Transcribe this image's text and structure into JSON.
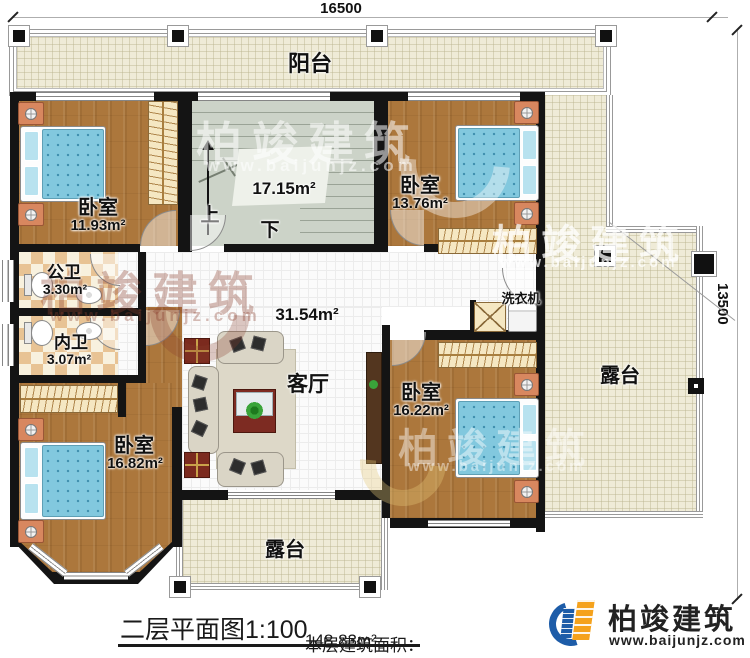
{
  "plan": {
    "title": "二层平面图1:100",
    "area_note_label": "本层建筑面积：",
    "area_note_value": "148.83m²"
  },
  "dimensions": {
    "top": "16500",
    "right": "13500"
  },
  "rooms": {
    "balcony": {
      "label": "阳台"
    },
    "bedroom_tl": {
      "label": "卧室",
      "area": "11.93m²"
    },
    "stair": {
      "area": "17.15m²",
      "up": "上",
      "down": "下"
    },
    "bedroom_tr": {
      "label": "卧室",
      "area": "13.76m²"
    },
    "bath_public": {
      "label": "公卫",
      "area": "3.30m²"
    },
    "bath_inner": {
      "label": "内卫",
      "area": "3.07m²"
    },
    "hall": {
      "area": "31.54m²"
    },
    "living": {
      "label": "客厅"
    },
    "bedroom_bl": {
      "label": "卧室",
      "area": "16.82m²"
    },
    "bedroom_br": {
      "label": "卧室",
      "area": "16.22m²"
    },
    "laundry": {
      "label": "洗衣机"
    },
    "terrace_right": {
      "label": "露台"
    },
    "terrace_bottom": {
      "label": "露台"
    }
  },
  "branding": {
    "company": "柏竣建筑",
    "website": "www.baijunjz.com"
  },
  "watermark": {
    "text": "柏竣建筑",
    "url": "www.baijunjz.com"
  },
  "colors": {
    "wall": "#141414",
    "wood_floor": "#ac773c",
    "tile_light": "#f8f1de",
    "tile_dark": "#e8c394",
    "terrace_floor": "#efebd7",
    "stair_floor": "#ccd3c8",
    "bed_blue": "#82c8de",
    "logo_blue": "#1d5ca8",
    "logo_orange": "#f5a21c"
  }
}
